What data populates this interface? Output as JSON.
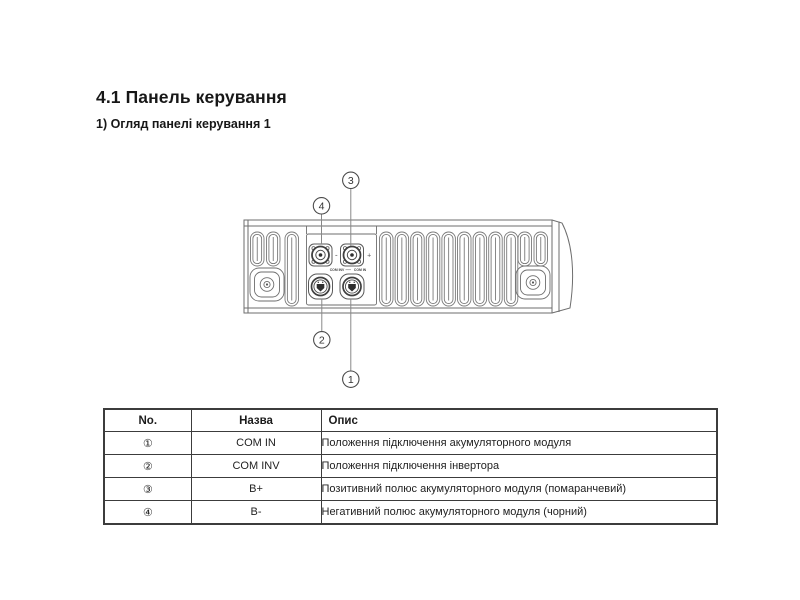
{
  "page": {
    "title": "4.1 Панель керування",
    "subtitle": "1) Огляд панелі керування 1"
  },
  "diagram": {
    "labels": {
      "com_inv": "COM INV",
      "com_in": "COM IN",
      "minus": "-",
      "plus": "+"
    },
    "callouts": [
      {
        "label": "1"
      },
      {
        "label": "2"
      },
      {
        "label": "3"
      },
      {
        "label": "4"
      }
    ]
  },
  "table": {
    "headers": [
      "No.",
      "Назва",
      "Опис"
    ],
    "rows": [
      {
        "no": "①",
        "name": "COM IN",
        "desc": "Положення підключення акумуляторного модуля"
      },
      {
        "no": "②",
        "name": "COM INV",
        "desc": "Положення підключення інвертора"
      },
      {
        "no": "③",
        "name": "B+",
        "desc": "Позитивний полюс акумуляторного модуля (помаранчевий)"
      },
      {
        "no": "④",
        "name": "B-",
        "desc": "Негативний полюс акумуляторного модуля (чорний)"
      }
    ]
  },
  "colors": {
    "drawing_line": "#6e6e6e",
    "drawing_dark": "#3f3f3f",
    "table_border": "#3c3c3c",
    "text": "#1a1a1a"
  }
}
